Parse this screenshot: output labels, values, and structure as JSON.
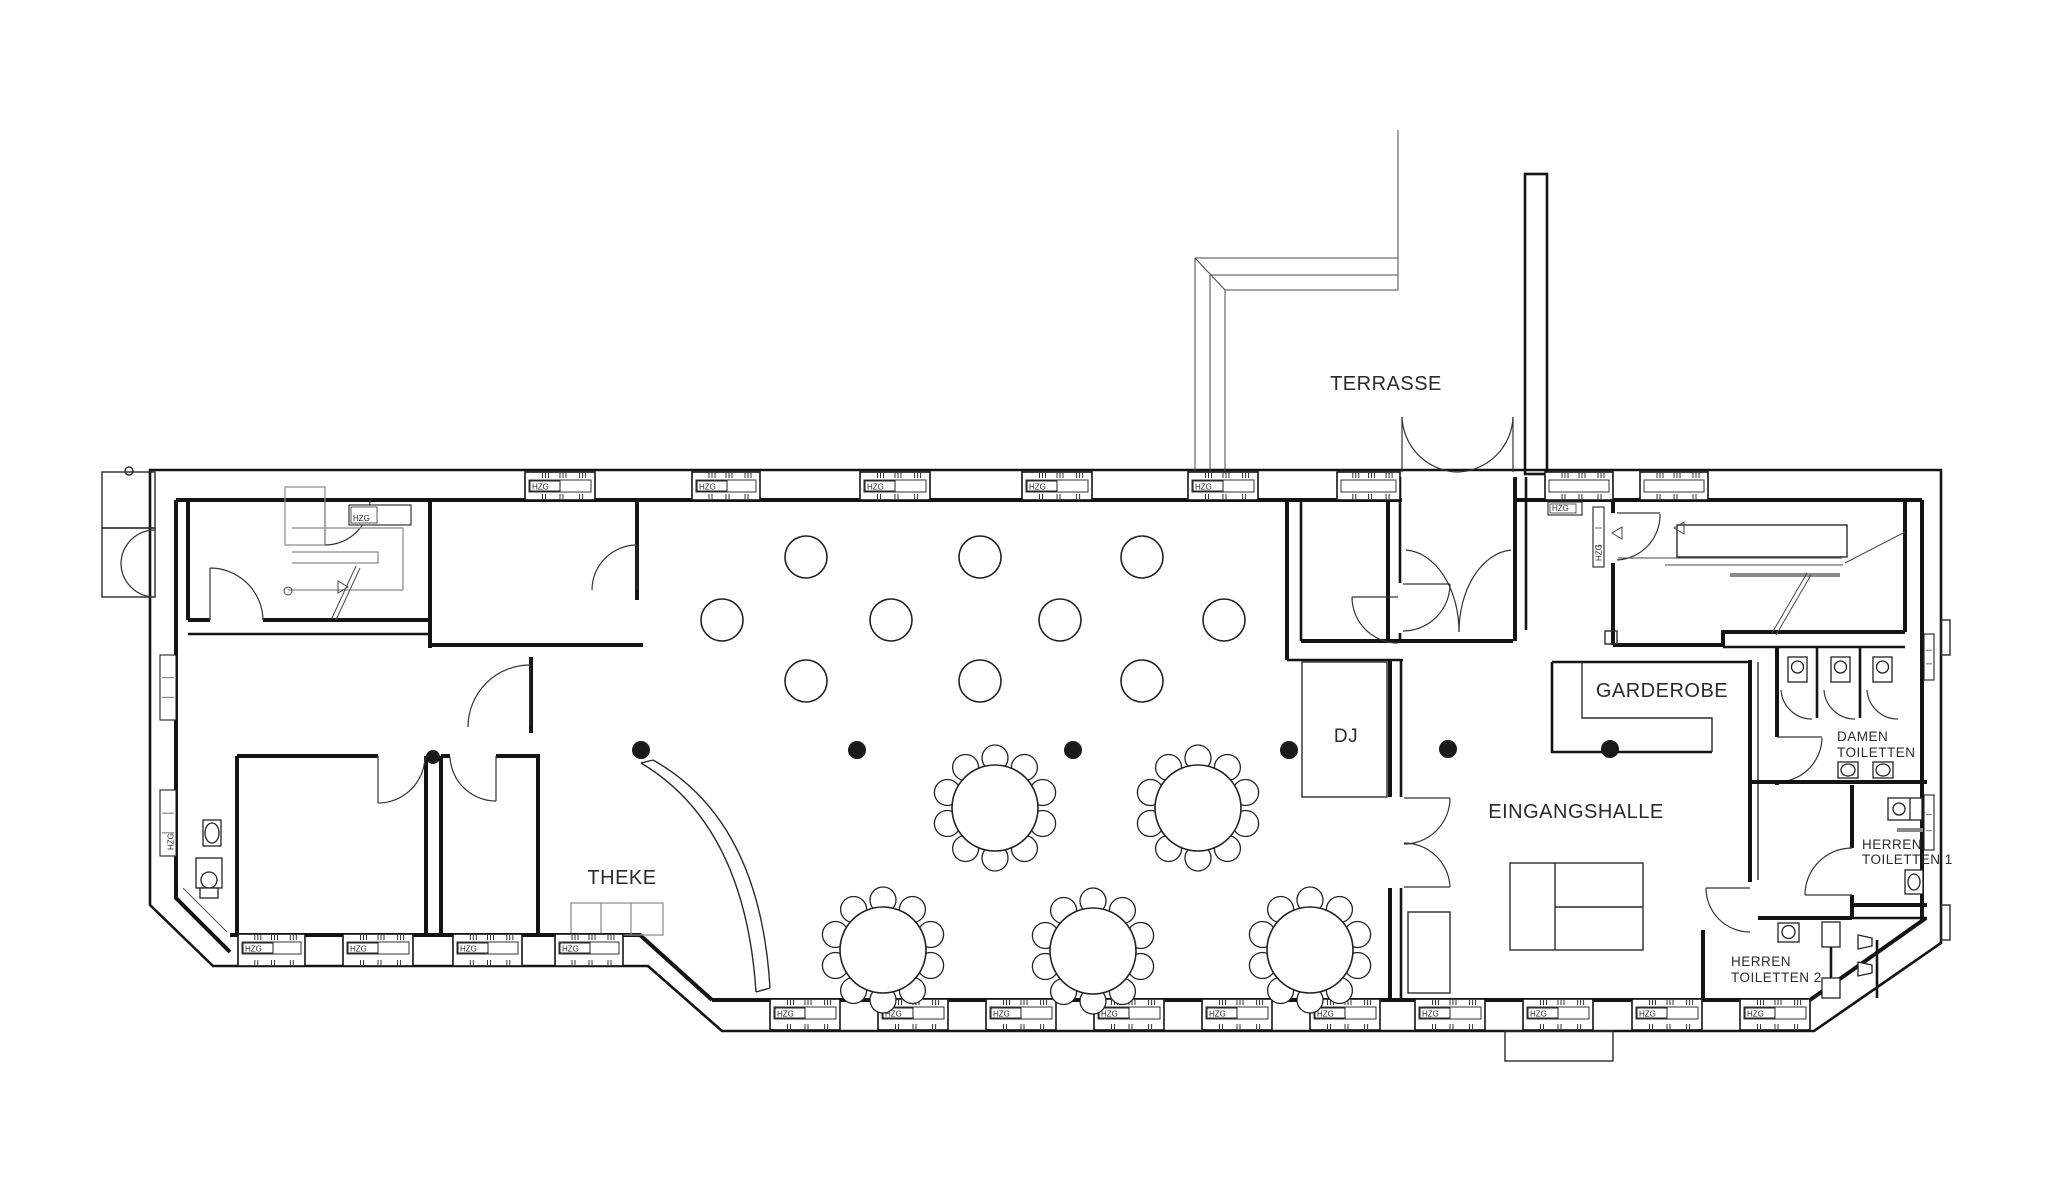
{
  "drawing": {
    "kind": "architectural floor plan (event venue / Festsaal)",
    "background": "#ffffff",
    "line_color": "#141414",
    "detail_color": "#8a8a8a"
  },
  "labels": {
    "rooms": [
      {
        "id": "terrasse",
        "text": "TERRASSE",
        "x": 1386,
        "y": 390,
        "size": 20,
        "anchor": "middle"
      },
      {
        "id": "garderobe",
        "text": "GARDEROBE",
        "x": 1662,
        "y": 697,
        "size": 20,
        "anchor": "middle"
      },
      {
        "id": "eingangshalle",
        "text": "EINGANGSHALLE",
        "x": 1576,
        "y": 818,
        "size": 20,
        "anchor": "middle"
      },
      {
        "id": "dj",
        "text": "DJ",
        "x": 1346,
        "y": 742,
        "size": 19,
        "anchor": "middle"
      },
      {
        "id": "theke",
        "text": "THEKE",
        "x": 622,
        "y": 884,
        "size": 20,
        "anchor": "middle"
      },
      {
        "id": "damen-line1",
        "text": "DAMEN",
        "x": 1837,
        "y": 741,
        "size": 13.5,
        "anchor": "start"
      },
      {
        "id": "damen-line2",
        "text": "TOILETTEN",
        "x": 1837,
        "y": 757,
        "size": 13.5,
        "anchor": "start"
      },
      {
        "id": "herren1-line1",
        "text": "HERREN",
        "x": 1862,
        "y": 849,
        "size": 13.5,
        "anchor": "start"
      },
      {
        "id": "herren1-line2",
        "text": "TOILETTEN 1",
        "x": 1862,
        "y": 864,
        "size": 13.5,
        "anchor": "start"
      },
      {
        "id": "herren2-line1",
        "text": "HERREN",
        "x": 1731,
        "y": 966,
        "size": 13.5,
        "anchor": "start"
      },
      {
        "id": "herren2-line2",
        "text": "TOILETTEN 2",
        "x": 1731,
        "y": 982,
        "size": 13.5,
        "anchor": "start"
      }
    ],
    "radiator": "HZG"
  },
  "windows": {
    "top": [
      {
        "x": 525,
        "w": 70,
        "hzg": true
      },
      {
        "x": 692,
        "w": 68,
        "hzg": true
      },
      {
        "x": 860,
        "w": 70,
        "hzg": true
      },
      {
        "x": 1022,
        "w": 70,
        "hzg": true
      },
      {
        "x": 1188,
        "w": 70,
        "hzg": true
      },
      {
        "x": 1337,
        "w": 63,
        "hzg": false
      },
      {
        "x": 1545,
        "w": 68,
        "hzg": false
      },
      {
        "x": 1640,
        "w": 68,
        "hzg": false
      }
    ],
    "top_band": {
      "y": 472,
      "h": 28
    },
    "bottom_hall": [
      {
        "x": 770,
        "w": 70,
        "hzg": true
      },
      {
        "x": 878,
        "w": 70,
        "hzg": true
      },
      {
        "x": 986,
        "w": 70,
        "hzg": true
      },
      {
        "x": 1094,
        "w": 70,
        "hzg": true
      },
      {
        "x": 1202,
        "w": 70,
        "hzg": true
      },
      {
        "x": 1310,
        "w": 70,
        "hzg": true
      },
      {
        "x": 1415,
        "w": 70,
        "hzg": true
      },
      {
        "x": 1523,
        "w": 70,
        "hzg": true
      },
      {
        "x": 1632,
        "w": 70,
        "hzg": true
      },
      {
        "x": 1740,
        "w": 70,
        "hzg": true
      }
    ],
    "bottom_band": {
      "y": 999,
      "h": 31
    },
    "under_rooms": [
      {
        "x": 238,
        "w": 67,
        "hzg": true
      },
      {
        "x": 343,
        "w": 70,
        "hzg": true
      },
      {
        "x": 453,
        "w": 69,
        "hzg": true
      },
      {
        "x": 555,
        "w": 68,
        "hzg": true
      }
    ],
    "under_rooms_band": {
      "y": 934,
      "h": 32
    },
    "left_wall_vertical": [
      {
        "x": 160,
        "y": 655,
        "w": 16,
        "h": 65,
        "hzg": false
      },
      {
        "x": 160,
        "y": 790,
        "w": 16,
        "h": 66,
        "hzg": true
      }
    ],
    "right_wall_vertical": [
      {
        "x": 1924,
        "y": 634,
        "w": 10,
        "h": 46,
        "hzg": false
      },
      {
        "x": 1924,
        "y": 795,
        "w": 10,
        "h": 55,
        "hzg": false
      }
    ],
    "passage_radiator": {
      "x": 1593,
      "y": 507,
      "w": 11,
      "h": 60,
      "hzg": true
    },
    "room1_radiator": {
      "x": 349,
      "y": 505,
      "w": 62,
      "h": 20,
      "hzg": true
    },
    "passage_box": {
      "x": 1548,
      "y": 502,
      "w": 34,
      "h": 13,
      "hzg": true
    }
  },
  "furniture": {
    "round_tables": {
      "table_r": 43,
      "chair_r": 13,
      "chairs_per_table": 10,
      "positions": [
        [
          995,
          808
        ],
        [
          1198,
          808
        ],
        [
          883,
          950
        ],
        [
          1093,
          951
        ],
        [
          1310,
          950
        ]
      ]
    },
    "small_circles": {
      "r": 21,
      "positions": [
        [
          806,
          557
        ],
        [
          980,
          557
        ],
        [
          1142,
          557
        ],
        [
          722,
          620
        ],
        [
          891,
          620
        ],
        [
          1060,
          620
        ],
        [
          1224,
          620
        ],
        [
          806,
          681
        ],
        [
          980,
          681
        ],
        [
          1142,
          681
        ]
      ]
    },
    "columns": {
      "r": 9,
      "positions": [
        [
          641,
          750
        ],
        [
          857,
          750
        ],
        [
          1073,
          750
        ],
        [
          1289,
          750
        ],
        [
          1448,
          749
        ],
        [
          1610,
          749
        ]
      ],
      "half_column": [
        433,
        757
      ]
    }
  }
}
